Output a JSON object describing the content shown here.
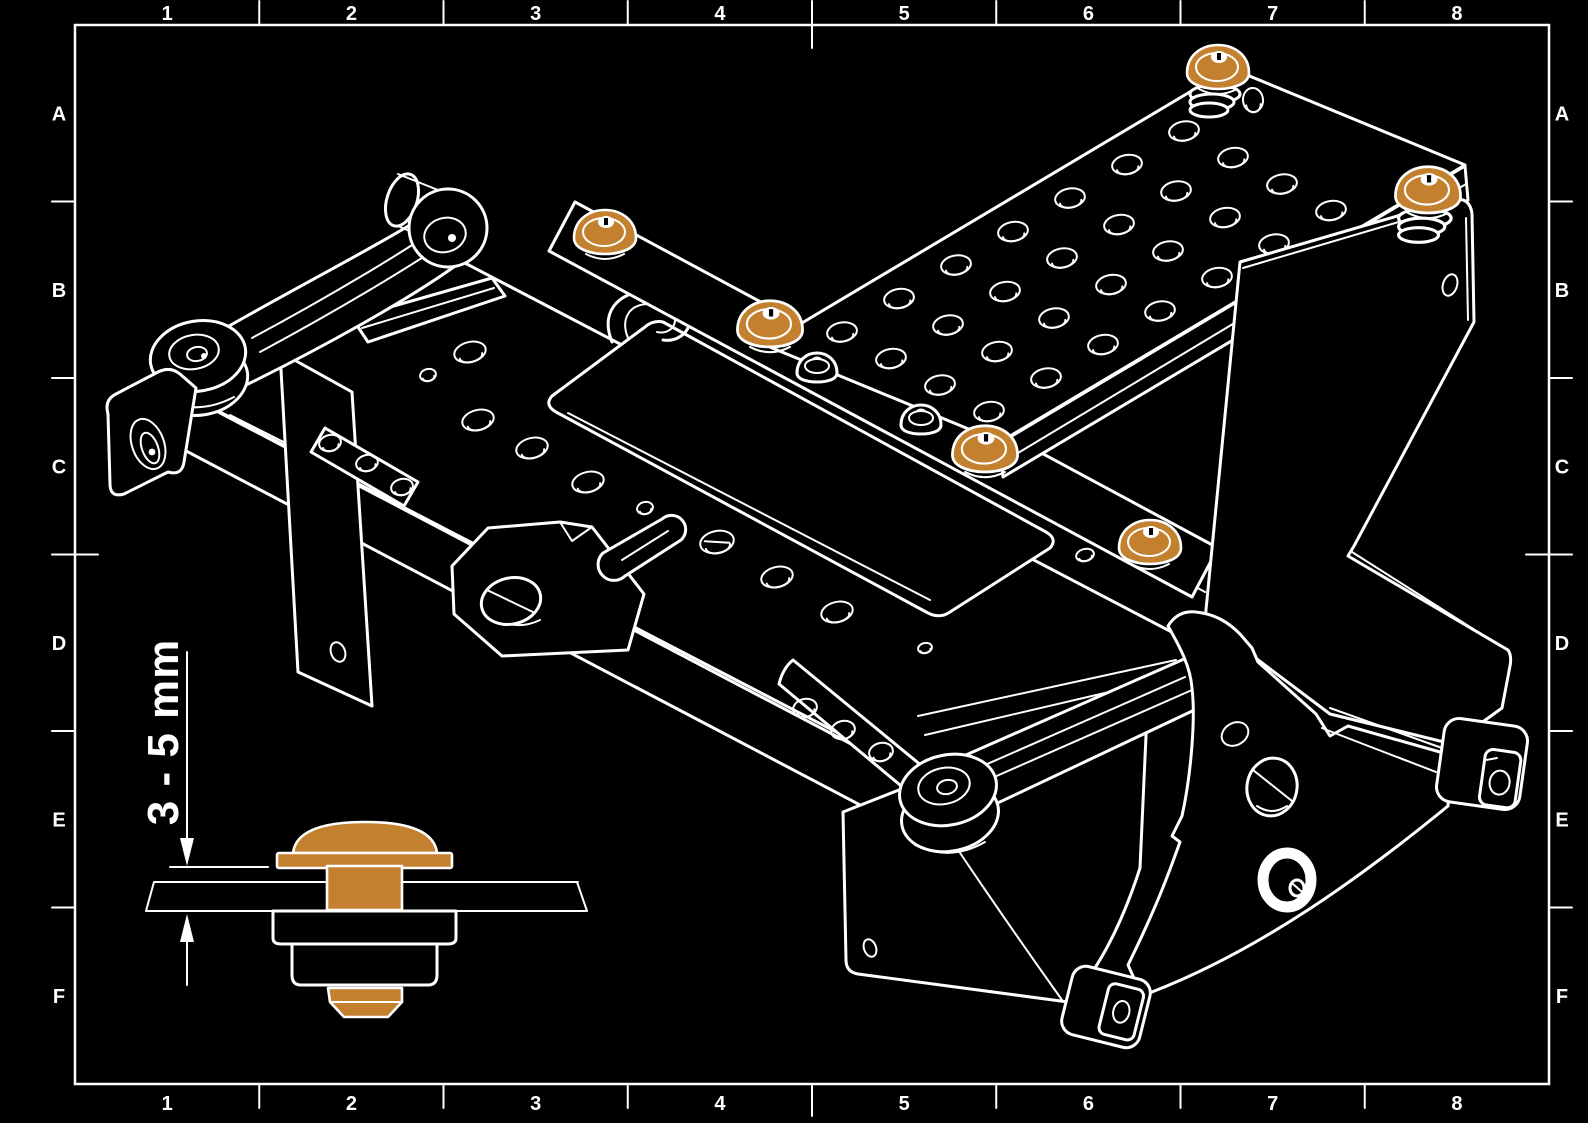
{
  "colors": {
    "background": "#000000",
    "line_color": "#ffffff",
    "highlight_color": "#c3812f"
  },
  "drawing_frame": {
    "column_labels": [
      "1",
      "2",
      "3",
      "4",
      "5",
      "6",
      "7",
      "8"
    ],
    "row_labels": [
      "A",
      "B",
      "C",
      "D",
      "E",
      "F"
    ]
  },
  "detail_view": {
    "dimension_label": "3 - 5 mm"
  },
  "main_view": {
    "highlighted_grommets": [
      {
        "x": 605,
        "y": 235,
        "scale": 1.0,
        "stack": false
      },
      {
        "x": 770,
        "y": 327,
        "scale": 1.05,
        "stack": false
      },
      {
        "x": 985,
        "y": 452,
        "scale": 1.05,
        "stack": false
      },
      {
        "x": 1150,
        "y": 545,
        "scale": 1.0,
        "stack": false
      },
      {
        "x": 1218,
        "y": 70,
        "scale": 1.0,
        "stack": true
      },
      {
        "x": 1428,
        "y": 193,
        "scale": 1.05,
        "stack": true
      }
    ],
    "plain_domes": [
      {
        "x": 817,
        "y": 367
      },
      {
        "x": 921,
        "y": 419
      }
    ]
  }
}
